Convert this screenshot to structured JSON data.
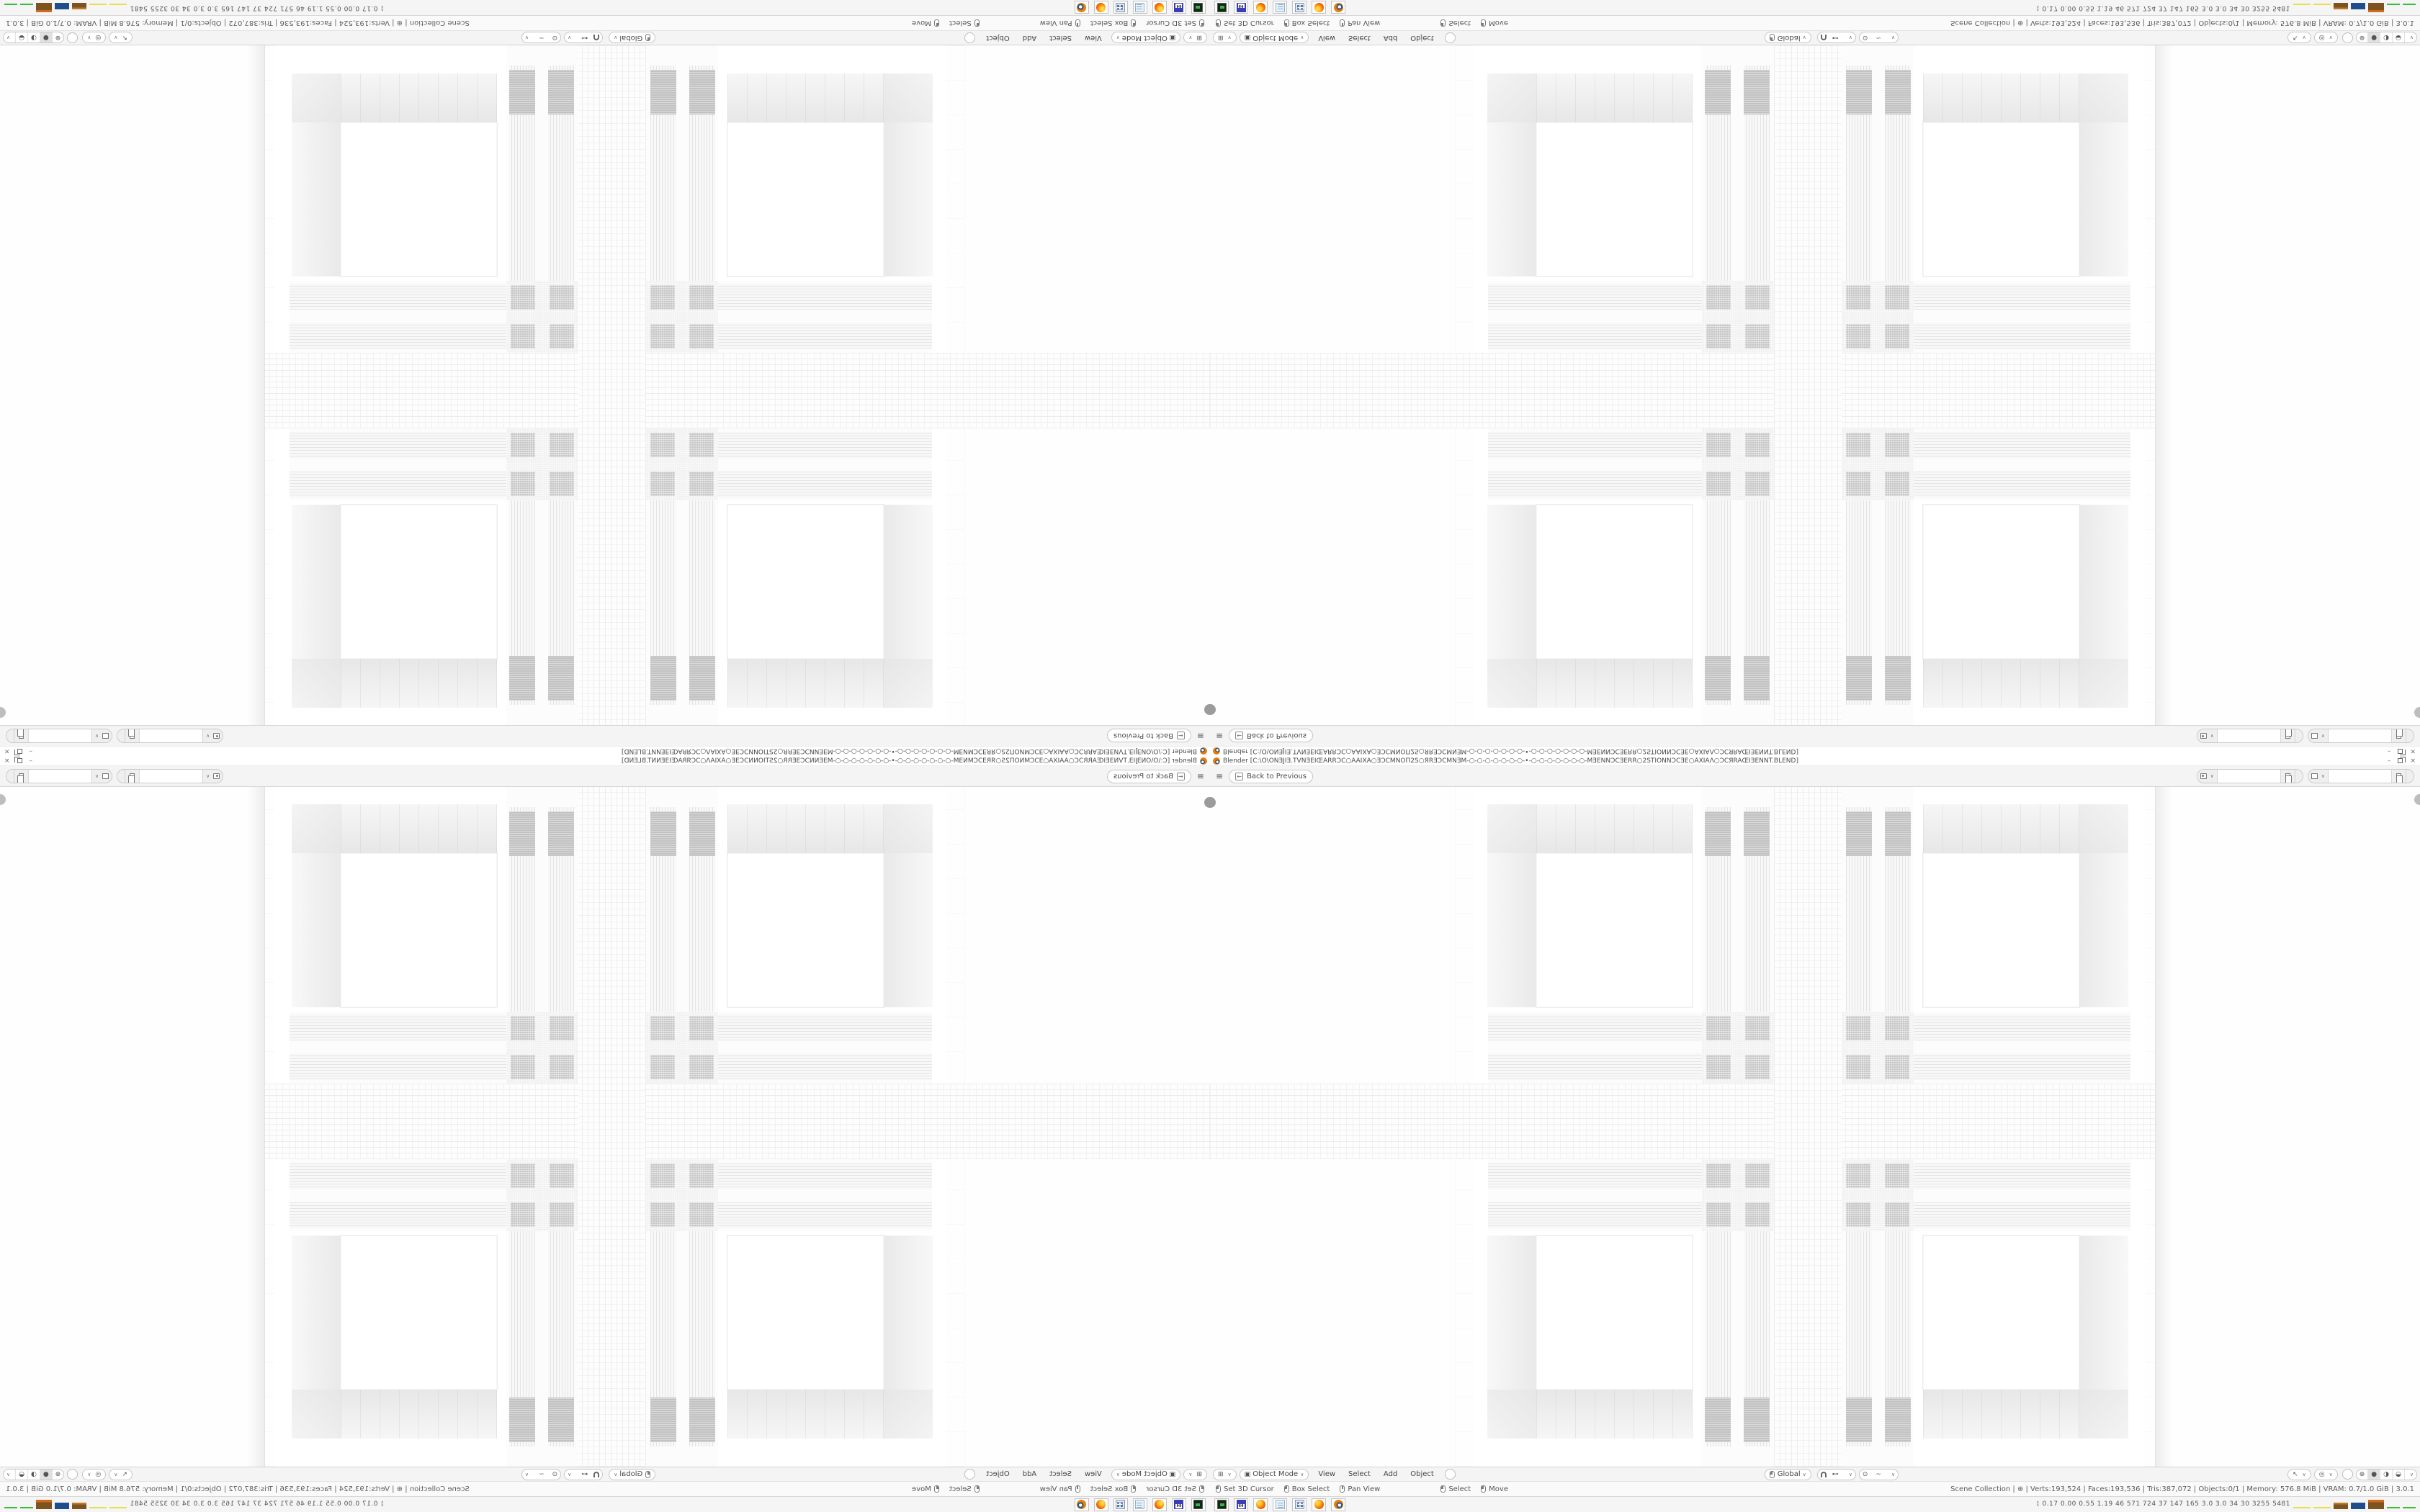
{
  "colors": {
    "blender_orange": "#e87d0d",
    "ui_panel": "#f4f4f4",
    "pill_border": "#c6c6c6",
    "render_wall_white": "#ffffff",
    "mullion_dark": "#c2c2c2",
    "tray_yellow": "#e6e04a",
    "tray_brown": "#7d5420",
    "tray_blue": "#1f4e8c",
    "tray_green": "#3dbb3d"
  },
  "window": {
    "titlebar": {
      "title": "Blender [C:\\O\\ONƎJIƎ.TVNƎEIŒARRƆC○AAIXA○ƎƆCMNOП2S○ЯRƎƆCMNƎM-○-○-○-○-○-○-○-•-○-○-○-○-○-○-○-MƎENNƆCƎERR○2STIONNƆCƎE○AXIAΛ○ƆCЯRAŒIƎENNT.BLEND]",
      "minimize": "–",
      "close": "×"
    },
    "topbar": {
      "hamburger": "≡",
      "back_icon": "←",
      "back_label": "Back to Previous",
      "scene_selector": {
        "value": "",
        "tooltip_name": "scene"
      },
      "view_layer_selector": {
        "value": "",
        "tooltip_name": "view-layer"
      }
    },
    "viewport_header": {
      "editor_icon": "⊞",
      "mode_icon": "▣",
      "mode_label": "Object Mode",
      "menus": [
        "View",
        "Select",
        "Add",
        "Object"
      ],
      "orientation_label": "Global",
      "snap_target_icon": "⊷",
      "proportional_icon": "⊙",
      "falloff_icon": "~",
      "gizmo_icon": "↖",
      "overlays_icon": "◎",
      "shading_modes": [
        "⊕",
        "●",
        "◑",
        "◒"
      ],
      "chevron": "∨"
    },
    "statusbar": {
      "hints": [
        {
          "mouse": "left",
          "label": "Set 3D Cursor"
        },
        {
          "mouse": "left-drag",
          "label": "Box Select"
        },
        {
          "mouse": "middle",
          "label": "Pan View"
        },
        {
          "mouse": "left",
          "label": "Select"
        },
        {
          "mouse": "left-drag",
          "label": "Move"
        }
      ],
      "stats_items": [
        "Scene Collection",
        "⊕",
        "Verts:193,524",
        "Faces:193,536",
        "Tris:387,072",
        "Objects:0/1",
        "Memory: 576.8 MiB",
        "VRAM: 0.7/1.0 GiB",
        "3.0.1"
      ],
      "stats_text": "Scene Collection  |  ⊕  |  Verts:193,524  |  Faces:193,536  |  Tris:387,072  |  Objects:0/1  |  Memory: 576.8 MiB  |  VRAM: 0.7/1.0 GiB  |  3.0.1"
    },
    "taskbar": {
      "apps": [
        "dosbox",
        "floppy-64",
        "firefox",
        "notepad",
        "calculator",
        "firefox",
        "blender"
      ],
      "floppy_label": "64",
      "tray_expander": "∧",
      "tray_stats": "0.17 0.00 0.55 1.19   46   571   724   37   147   165   3.0   3.0   34   30   3255 5481"
    }
  }
}
